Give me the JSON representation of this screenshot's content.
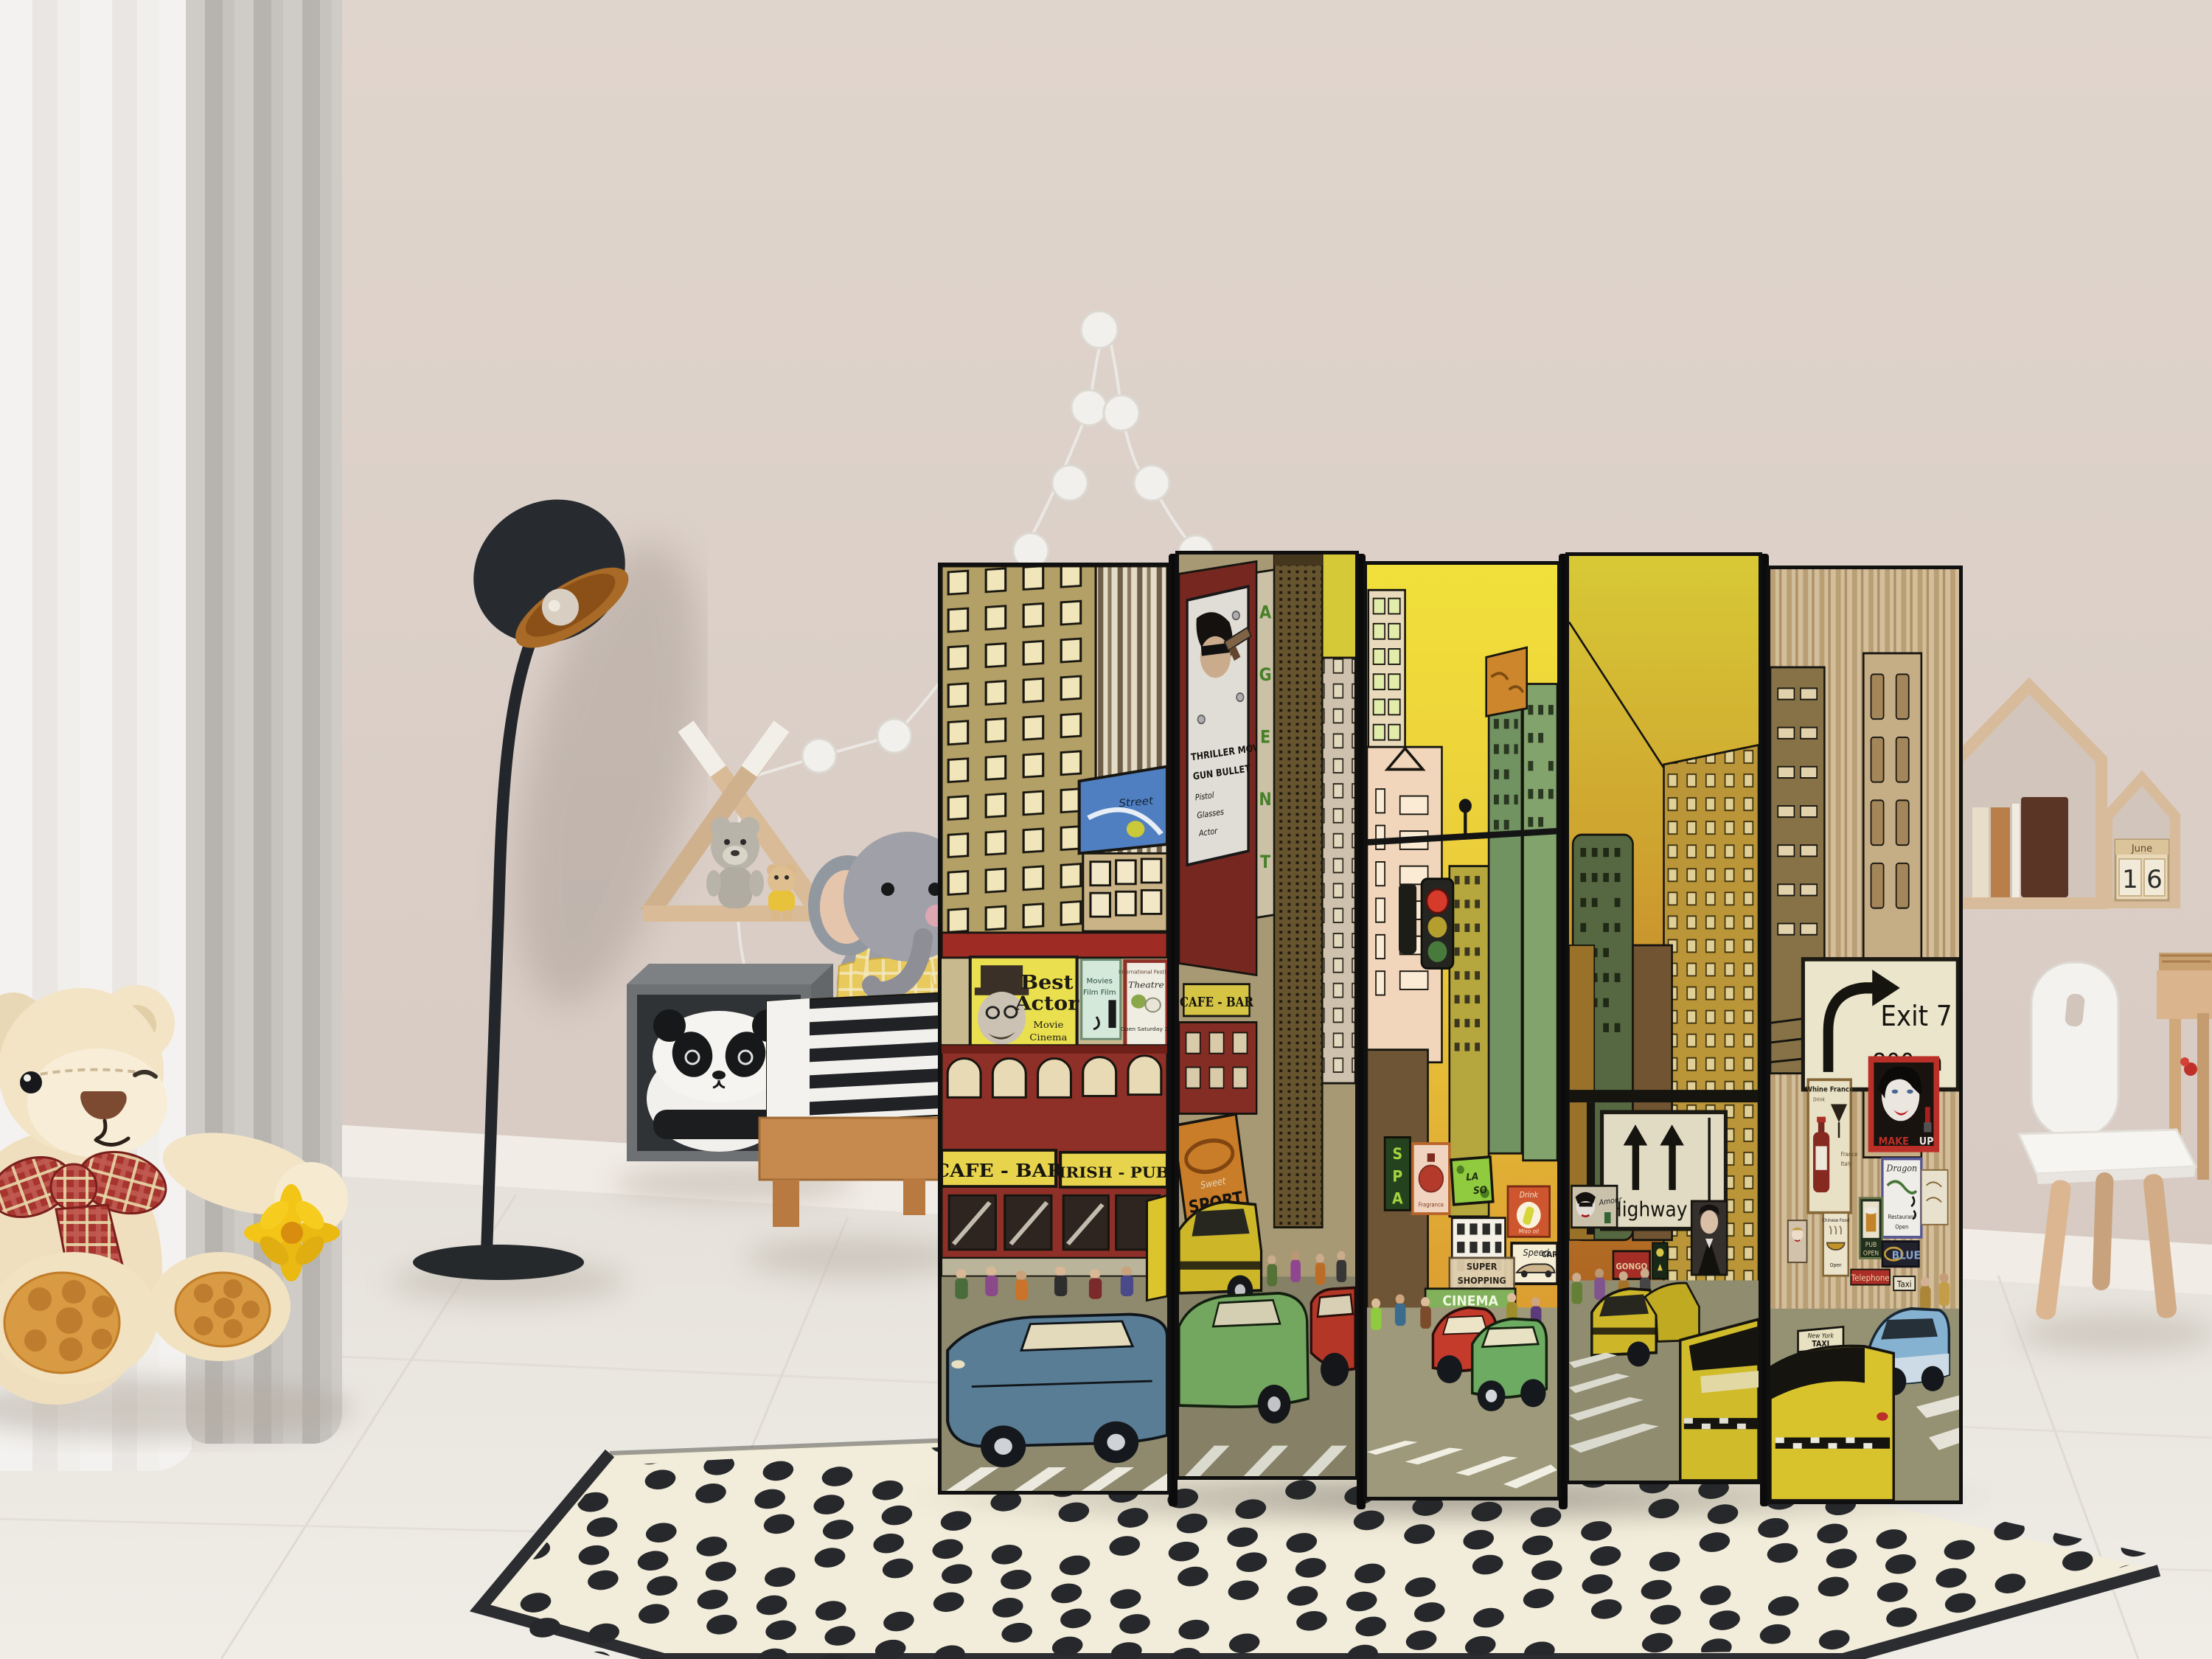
{
  "room": {
    "calendar": {
      "month": "June",
      "day_tens": "1",
      "day_ones": "6"
    }
  },
  "colors": {
    "wall": "#d8cbc3",
    "floor": "#ebe7e1",
    "curtain_gray": "#c2bfbb",
    "sky_yellow": "#e9da3a",
    "sky_orange": "#c87a28",
    "taxi_yellow": "#dcc52c",
    "brick_red": "#8e3028",
    "sign_yellow": "#e8d44c",
    "rug_cream": "#f2ecda",
    "rug_dot": "#26282c",
    "panel_frame": "#101010"
  },
  "divider": {
    "signs": {
      "street": "Street",
      "best_actor": {
        "l1": "Best",
        "l2": "Actor",
        "l3": "Movie",
        "l4": "Cinema",
        "l5": "Adventure",
        "l6": "Saturday 18h45 PM"
      },
      "cafe_bar": "CAFE - BAR",
      "irish_pub": "IRISH - PUB",
      "movies_poster": {
        "l1": "Movies",
        "l2": "Film Film"
      },
      "theatre_poster": {
        "top": "International Festival",
        "title": "Theatre",
        "bottom": "Open Saturday 22"
      },
      "thriller": {
        "l1": "THRILLER MOVIE",
        "l2": "GUN BULLET",
        "l3": "Pistol",
        "l4": "Glasses",
        "l5": "Actor"
      },
      "agent": [
        "A",
        "G",
        "E",
        "N",
        "T"
      ],
      "cafe_bar_2": "CAFE - BAR",
      "sport": {
        "l1": "Sweet",
        "l2": "SPORT"
      },
      "spa": [
        "S",
        "P",
        "A"
      ],
      "fragrance": "Fragrance",
      "laso": {
        "l1": "LA",
        "l2": "SO"
      },
      "super_shopping": {
        "l1": "SUPER",
        "l2": "SHOPPING"
      },
      "cinema": "CINEMA",
      "drink": {
        "l1": "Drink",
        "l2": "Miso oil"
      },
      "speed_car": {
        "l1": "Speed",
        "l2": "CAR"
      },
      "amour": "Amour",
      "gongo": "GONGO",
      "highway": "Highway",
      "exit": {
        "l1": "Exit 7",
        "l2": "800 m"
      },
      "wine": {
        "l1": "Whine France",
        "l2": "Drink",
        "l3": "France",
        "l4": "Italy"
      },
      "makeup": {
        "l1": "MAKE",
        "l2": "UP"
      },
      "dragon": {
        "l1": "Dragon",
        "l2": "Restaurant",
        "l3": "Open"
      },
      "chinese": {
        "l1": "Chinese Food",
        "l2": "Open"
      },
      "pub": {
        "l1": "PUB",
        "l2": "OPEN"
      },
      "blue": "BLUE",
      "telephone": "Telephone",
      "taxi": "Taxi",
      "ny_taxi": {
        "l1": "New York",
        "l2": "TAXI"
      }
    }
  }
}
